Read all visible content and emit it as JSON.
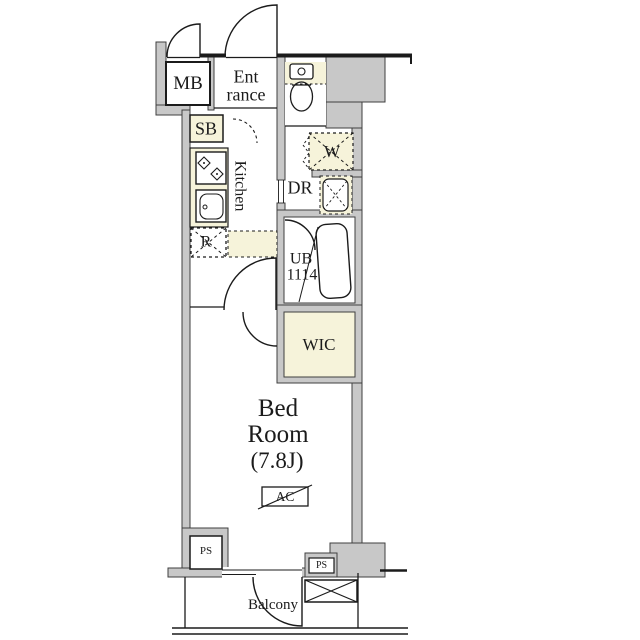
{
  "floor_plan": {
    "rooms": {
      "meter_box": "MB",
      "entrance": {
        "line1": "Ent",
        "line2": "rance"
      },
      "shoe_box": "SB",
      "kitchen": "Kitchen",
      "dressing_room": "DR",
      "washer": "W",
      "refrigerator": "R",
      "unit_bath": {
        "line1": "UB",
        "line2": "1114"
      },
      "walk_in_closet": "WIC",
      "bedroom": {
        "line1": "Bed",
        "line2": "Room",
        "size": "(7.8J)"
      },
      "air_conditioner": "AC",
      "pipe_space_left": "PS",
      "pipe_space_right": "PS",
      "balcony": "Balcony"
    },
    "colors": {
      "wall": "#c8c8c8",
      "outline": "#1b1b1b",
      "accent_cream": "#f6f3da",
      "floor": "#ffffff"
    }
  }
}
